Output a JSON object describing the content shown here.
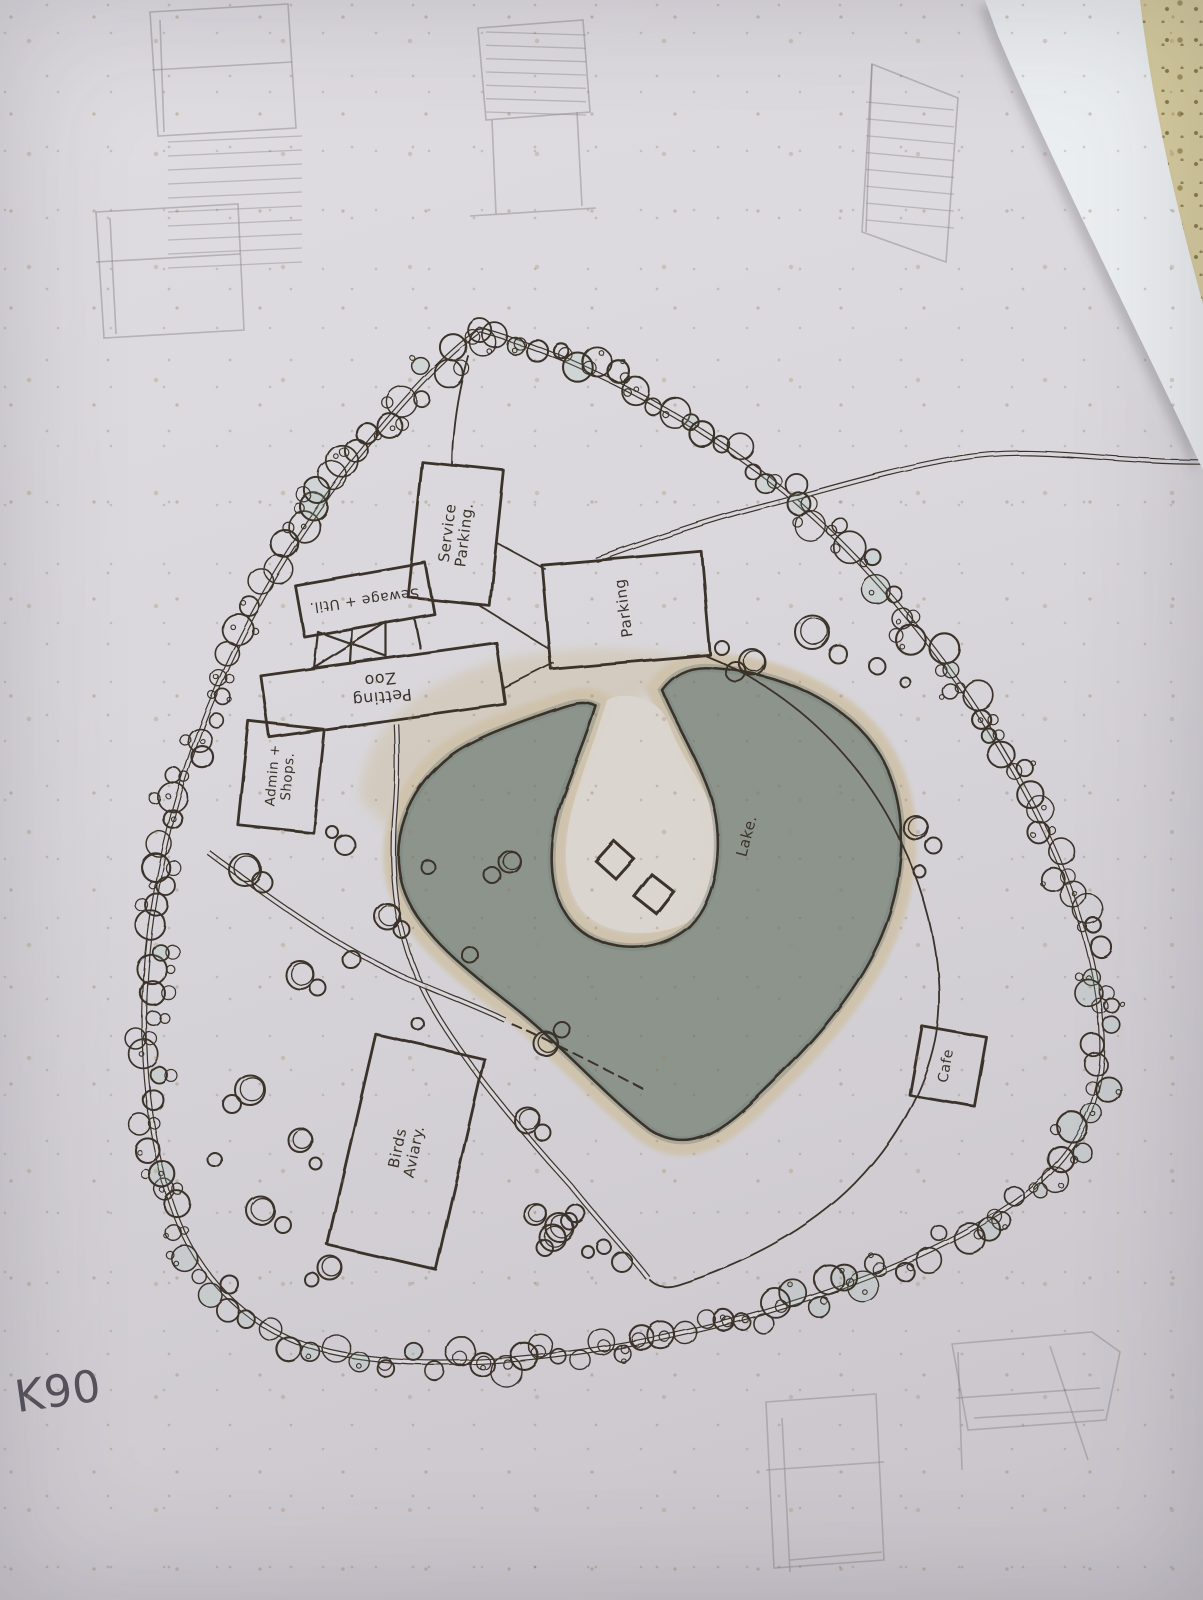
{
  "labels": {
    "service_parking": {
      "text": "Service\nParking.",
      "x": 456,
      "y": 534,
      "rot": -83,
      "size": 15
    },
    "sewage_util": {
      "text": "Sewage + Util.",
      "x": 364,
      "y": 599,
      "rot": 172,
      "size": 14
    },
    "petting_zoo": {
      "text": "Petting\nZoo",
      "x": 381,
      "y": 688,
      "rot": 174,
      "size": 16
    },
    "admin_shops": {
      "text": "Admin +\nShops.",
      "x": 281,
      "y": 776,
      "rot": -85,
      "size": 13.5
    },
    "parking": {
      "text": "Parking",
      "x": 624,
      "y": 608,
      "rot": -98,
      "size": 15
    },
    "cafe": {
      "text": "Cafe",
      "x": 947,
      "y": 1066,
      "rot": -80,
      "size": 14
    },
    "birds_aviary": {
      "text": "Birds\nAviary.",
      "x": 406,
      "y": 1150,
      "rot": -78,
      "size": 15
    },
    "lake": {
      "text": "Lake.",
      "x": 747,
      "y": 836,
      "rot": -75,
      "size": 15
    },
    "k90": {
      "text": "K90",
      "x": 58,
      "y": 1392,
      "rot": -8,
      "size": 44,
      "color": "#56525c"
    }
  },
  "colors": {
    "ink": "#3b332b",
    "pencil": "#8e888c",
    "paper": "#d8d6da",
    "lake": "#8c948c",
    "lake_edge": "#74817a",
    "sand": "#cfc2aa",
    "island": "#dad5cf",
    "sheet": "#ebeef0",
    "sheet_shadow": "rgba(95,90,102,0.28)"
  },
  "map": {
    "ring_path": "M 480 330 C 560 352 660 398 760 472 C 860 548 960 668 1030 800 C 1075 886 1100 970 1102 1040 C 1104 1110 1070 1168 1000 1212 C 920 1262 800 1308 660 1338 C 540 1362 420 1372 330 1352 C 255 1335 198 1282 172 1205 C 150 1140 140 1060 146 975 C 152 890 172 800 208 710 C 246 616 304 520 368 444 C 406 398 444 356 480 330 Z",
    "road_path": "M 1203 462 C 1100 462 1040 445 960 458 C 880 472 820 492 768 505 C 716 518 650 540 596 560",
    "lake_path": "M 560 708 C 520 722 470 738 445 760 C 408 792 390 838 402 884 C 416 934 470 972 520 1012 C 566 1050 606 1096 650 1130 C 690 1156 724 1130 762 1092 C 806 1050 852 1000 878 944 C 905 886 912 810 880 755 C 848 702 780 672 712 668 C 688 666 672 676 662 690 C 676 724 700 762 712 800 C 724 842 718 898 690 926 C 654 958 596 952 570 920 C 546 890 548 840 562 800 C 574 766 588 734 596 706 C 584 700 572 704 560 708 Z",
    "island_path": "M 607 700 C 596 736 586 762 576 795 C 563 836 560 882 582 910 C 604 936 658 942 694 918 C 724 897 730 856 718 822 C 707 790 680 755 668 722 C 659 698 625 690 607 700 Z",
    "sand_wash": "M 360 800 C 360 730 420 680 500 660 C 570 645 640 645 690 660 C 640 700 610 720 590 760 C 560 745 520 740 480 750 C 430 762 400 790 390 830 Z",
    "double_paths": [
      "M 396 724 C 398 770 396 796 394 822 C 390 900 402 960 440 1020 C 470 1068 520 1130 570 1185 C 600 1222 628 1252 648 1278",
      "M 208 852 C 282 908 344 950 402 976 C 438 992 470 1004 505 1020"
    ],
    "single_paths": [
      "M 706 656 C 792 690 864 760 903 846 C 937 918 945 990 935 1040 C 924 1092 896 1142 855 1184 C 810 1230 745 1264 678 1285 C 668 1288 658 1288 650 1280",
      "M 497 543 L 545 569",
      "M 480 606 L 549 649",
      "M 503 688 L 553 663",
      "M 452 466 C 452 430 458 392 468 356"
    ],
    "dashed_paths": [
      "M 512 1024 C 556 1044 600 1066 645 1090"
    ],
    "trellis": "M 318 632 L 314 668 M 352 628 L 350 662 M 386 624 L 386 658 M 318 632 L 386 656 M 386 622 L 316 666 M 312 668 L 400 656 M 414 618 L 420 648",
    "buildings": [
      {
        "key": "service_parking",
        "cx": 456,
        "cy": 534,
        "w": 82,
        "h": 136,
        "rot": 6
      },
      {
        "key": "sewage_util",
        "cx": 365,
        "cy": 600,
        "w": 132,
        "h": 52,
        "rot": -10
      },
      {
        "key": "petting_zoo",
        "cx": 383,
        "cy": 690,
        "w": 238,
        "h": 62,
        "rot": -8
      },
      {
        "key": "admin_shops",
        "cx": 281,
        "cy": 777,
        "w": 76,
        "h": 104,
        "rot": 6
      },
      {
        "key": "parking",
        "cx": 626,
        "cy": 610,
        "w": 160,
        "h": 104,
        "rot": -5
      },
      {
        "key": "cafe",
        "cx": 948,
        "cy": 1066,
        "w": 66,
        "h": 70,
        "rot": 10
      },
      {
        "key": "birds_aviary",
        "cx": 406,
        "cy": 1152,
        "w": 112,
        "h": 216,
        "rot": 13
      }
    ],
    "diamonds": [
      {
        "cx": 615,
        "cy": 860,
        "s": 27,
        "rot": 42
      },
      {
        "cx": 654,
        "cy": 894,
        "s": 28,
        "rot": 38
      }
    ],
    "scattered_trees": [
      [
        245,
        870,
        16
      ],
      [
        262,
        882,
        10
      ],
      [
        300,
        975,
        14
      ],
      [
        318,
        988,
        8
      ],
      [
        250,
        1090,
        15
      ],
      [
        232,
        1104,
        9
      ],
      [
        300,
        1140,
        12
      ],
      [
        260,
        1210,
        14
      ],
      [
        282,
        1224,
        8
      ],
      [
        330,
        1268,
        12
      ],
      [
        312,
        1280,
        7
      ],
      [
        230,
        1285,
        9
      ],
      [
        215,
        1160,
        7
      ],
      [
        352,
        960,
        9
      ],
      [
        388,
        917,
        13
      ],
      [
        402,
        930,
        8
      ],
      [
        345,
        845,
        10
      ],
      [
        332,
        832,
        6
      ],
      [
        428,
        867,
        7
      ],
      [
        510,
        862,
        11
      ],
      [
        493,
        876,
        8
      ],
      [
        546,
        1044,
        12
      ],
      [
        562,
        1030,
        8
      ],
      [
        527,
        1120,
        13
      ],
      [
        543,
        1133,
        8
      ],
      [
        560,
        1228,
        14
      ],
      [
        576,
        1214,
        9
      ],
      [
        545,
        1248,
        8
      ],
      [
        316,
        1164,
        6
      ],
      [
        604,
        1247,
        7
      ],
      [
        622,
        1262,
        10
      ],
      [
        418,
        1024,
        6
      ],
      [
        470,
        955,
        8
      ],
      [
        722,
        648,
        7
      ],
      [
        752,
        662,
        13
      ],
      [
        736,
        672,
        10
      ],
      [
        812,
        632,
        17
      ],
      [
        838,
        654,
        9
      ],
      [
        877,
        666,
        8
      ],
      [
        905,
        682,
        5
      ],
      [
        916,
        828,
        12
      ],
      [
        934,
        846,
        8
      ],
      [
        920,
        872,
        6
      ],
      [
        536,
        1215,
        11
      ],
      [
        553,
        1238,
        13
      ],
      [
        570,
        1222,
        8
      ],
      [
        588,
        1252,
        6
      ]
    ],
    "ring_trees": {
      "seed": 11,
      "spacing": 21,
      "jitter": 13,
      "rmin": 7,
      "rmax": 16
    },
    "pencil_sketches": [
      {
        "paths": [
          "M150 12 L288 4 L296 128 L158 136 Z",
          "M160 20 L164 132",
          "M152 70 L292 62"
        ],
        "hatch": [
          168,
          142,
          134,
          126,
          10,
          -6
        ]
      },
      {
        "paths": [
          "M96 212 L238 204 L244 330 L104 338 Z",
          "M110 218 L116 334",
          "M96 262 L240 254"
        ]
      },
      {
        "paths": [
          "M478 28 L583 20 L590 112 L486 120 Z",
          "M492 120 L496 214",
          "M577 112 L582 206",
          "M470 216 L596 208"
        ],
        "hatch": [
          486,
          32,
          100,
          80,
          7,
          3
        ]
      },
      {
        "paths": [
          "M872 64 L958 98 L946 262 L862 232 Z",
          "M872 64 L866 232"
        ],
        "hatch": [
          866,
          102,
          88,
          118,
          8,
          8
        ]
      },
      {
        "paths": [
          "M766 1402 L876 1394 L884 1560 L774 1568 Z",
          "M782 1418 L790 1572",
          "M766 1470 L884 1462",
          "M790 1560 L882 1552"
        ]
      },
      {
        "paths": [
          "M952 1344 L1092 1332 L1120 1352 L1106 1420 L968 1430 Z",
          "M958 1352 L962 1470",
          "M1050 1346 L1088 1460",
          "M956 1398 L1100 1388",
          "M974 1418 L1104 1410"
        ]
      }
    ],
    "sheet_path": "M 985 0 L 1140 0 C 1152 104 1178 214 1203 304 L 1203 470 C 1146 348 1050 158 998 36 Z"
  }
}
